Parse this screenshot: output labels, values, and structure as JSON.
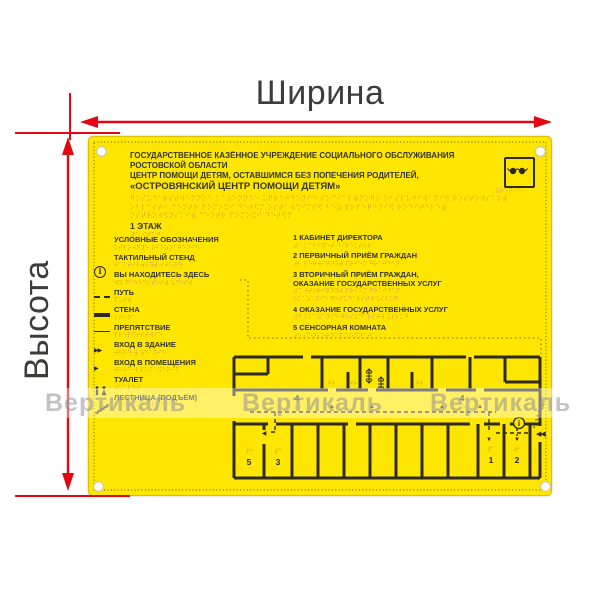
{
  "dimensions": {
    "width_label": "Ширина",
    "height_label": "Высота",
    "arrow_color": "#e30613"
  },
  "watermark": {
    "text": "Вертикаль"
  },
  "panel": {
    "bg_color": "#ffe600",
    "title_lines": [
      "ГОСУДАРСТВЕННОЕ КАЗЁННОЕ УЧРЕЖДЕНИЕ СОЦИАЛЬНОГО ОБСЛУЖИВАНИЯ",
      "РОСТОВСКОЙ ОБЛАСТИ",
      "ЦЕНТР ПОМОЩИ ДЕТЯМ, ОСТАВШИМСЯ БЕЗ ПОПЕЧЕНИЯ РОДИТЕЛЕЙ,",
      "«ОСТРОВЯНСКИЙ ЦЕНТР ПОМОЩИ ДЕТЯМ»"
    ],
    "title_braille": [
      "⠛⠕⠎⠥⠙⠁⠗⠎⠞⠺⠑⠝⠝⠕⠑ ⠅⠁⠵⠑⠝⠝⠕⠑ ⠥⠟⠗⠑⠚⠙⠑⠝⠊⠑ ⠎⠕⠉⠊⠁⠇⠾⠝⠕⠛⠕ ⠕⠃⠎⠇⠥⠚⠊⠺⠁⠝⠊⠫ ⠗⠕⠎⠞⠕⠺⠎⠅⠕⠾",
      "⠕⠃⠇⠁⠎⠞⠊ ⠉⠑⠝⠞⠗ ⠏⠕⠍⠕⠭⠊ ⠙⠑⠞⠫⠍ ⠕⠎⠞⠁⠺⠩⠊⠍⠎⠫ ⠃⠑⠵ ⠏⠕⠏⠑⠟⠑⠝⠊⠫ ⠗⠕⠙⠊⠞⠑⠇⠑⠾",
      "⠕⠎⠞⠗⠕⠺⠫⠝⠎⠅⠊⠾ ⠉⠑⠝⠞⠗ ⠏⠕⠍⠕⠭⠊ ⠙⠑⠞⠫⠍"
    ],
    "floor_label": "1 ЭТАЖ",
    "floor_braille": "⠼⠁ ⠪⠞⠁⠚",
    "blind_icon_braille": "⠵⠗⠑⠝⠊⠑",
    "legend_heading": {
      "label": "УСЛОВНЫЕ ОБОЗНАЧЕНИЯ",
      "braille": "⠥⠎⠇⠕⠺⠝⠽⠑ ⠕⠃⠕⠵⠝⠁⠟⠑⠝⠊⠫"
    },
    "legend_items": [
      {
        "label": "ТАКТИЛЬНЫЙ СТЕНД",
        "braille": "⠞⠁⠅⠞⠊⠇⠾⠝⠽⠾ ⠎⠞⠑⠝⠙",
        "icon": "info-circle-icon"
      },
      {
        "label": "ВЫ НАХОДИТЕСЬ ЗДЕСЬ",
        "braille": "⠺⠽ ⠝⠁⠓⠕⠙⠊⠞⠑⠎⠾ ⠵⠙⠑⠎⠾",
        "icon": "none"
      },
      {
        "label": "ПУТЬ",
        "braille": "⠏⠥⠞⠾",
        "icon": "dashed-path-icon"
      },
      {
        "label": "СТЕНА",
        "braille": "⠎⠞⠑⠝⠁",
        "icon": "wall-line-icon"
      },
      {
        "label": "ПРЕПЯТСТВИЕ",
        "braille": "⠏⠗⠑⠏⠫⠞⠎⠞⠺⠊⠑",
        "icon": "obstacle-line-icon"
      },
      {
        "label": "ВХОД В ЗДАНИЕ",
        "braille": "⠺⠓⠕⠙ ⠺ ⠵⠙⠁⠝⠊⠑",
        "icon": "building-entrance-icon"
      },
      {
        "label": "ВХОД В ПОМЕЩЕНИЯ",
        "braille": "⠺⠓⠕⠙ ⠺ ⠏⠕⠍⠑⠭⠑⠝⠊⠫",
        "icon": "room-entrance-icon"
      },
      {
        "label": "ТУАЛЕТ",
        "braille": "⠞⠥⠁⠇⠑⠞",
        "icon": "toilet-icon"
      },
      {
        "label": "ЛЕСТНИЦА (ПОДЪЁМ)",
        "braille": "⠇⠑⠎⠞⠝⠊⠉⠁ ⠏⠕⠙⠜⠑⠍",
        "icon": "stairs-icon"
      }
    ],
    "rooms": [
      {
        "label": "1 КАБИНЕТ ДИРЕКТОРА",
        "braille": "⠼⠁ ⠅⠁⠃⠊⠝⠑⠞ ⠙⠊⠗⠑⠅⠞⠕⠗⠁"
      },
      {
        "label": "2 ПЕРВИЧНЫЙ ПРИЁМ ГРАЖДАН",
        "braille": "⠼⠃ ⠏⠑⠗⠺⠊⠟⠝⠽⠾ ⠏⠗⠊⠑⠍ ⠛⠗⠁⠚⠙⠁⠝"
      },
      {
        "label": "3 ВТОРИЧНЫЙ ПРИЁМ ГРАЖДАН,",
        "label2": "ОКАЗАНИЕ ГОСУДАРСТВЕННЫХ УСЛУГ",
        "braille": "⠼⠉ ⠺⠞⠕⠗⠊⠟⠝⠽⠾ ⠏⠗⠊⠑⠍ ⠛⠗⠁⠚⠙⠁⠝",
        "braille2": "⠕⠅⠁⠵⠁⠝⠊⠑ ⠛⠕⠎⠥⠙⠁⠗⠎⠞⠺ ⠥⠎⠇⠥⠛"
      },
      {
        "label": "4 ОКАЗАНИЕ ГОСУДАРСТВЕННЫХ УСЛУГ",
        "braille": "⠼⠙ ⠕⠅⠁⠵⠁⠝⠊⠑ ⠛⠕⠎⠥⠙⠁⠗⠎⠞⠺ ⠥⠎⠇⠥⠛"
      },
      {
        "label": "5 СЕНСОРНАЯ КОМНАТА",
        "braille": "⠼⠑ ⠎⠑⠝⠎⠕⠗⠝⠁⠫ ⠅⠕⠍⠝⠁⠞⠁"
      }
    ],
    "plan": {
      "numbers": {
        "n1": "1",
        "n2": "2",
        "n3": "3",
        "n4": "4",
        "n5": "5"
      },
      "tags": {
        "t1": "⠼⠁",
        "t2": "⠼⠃",
        "t3": "⠼⠉",
        "t4": "⠼⠙",
        "t5": "⠼⠑",
        "door": "⠋⠇"
      },
      "up_arrow": "▲",
      "down_arrow": "▼",
      "left_arrow": "◀",
      "entrance": "◀◀",
      "info_glyph": "i"
    }
  }
}
